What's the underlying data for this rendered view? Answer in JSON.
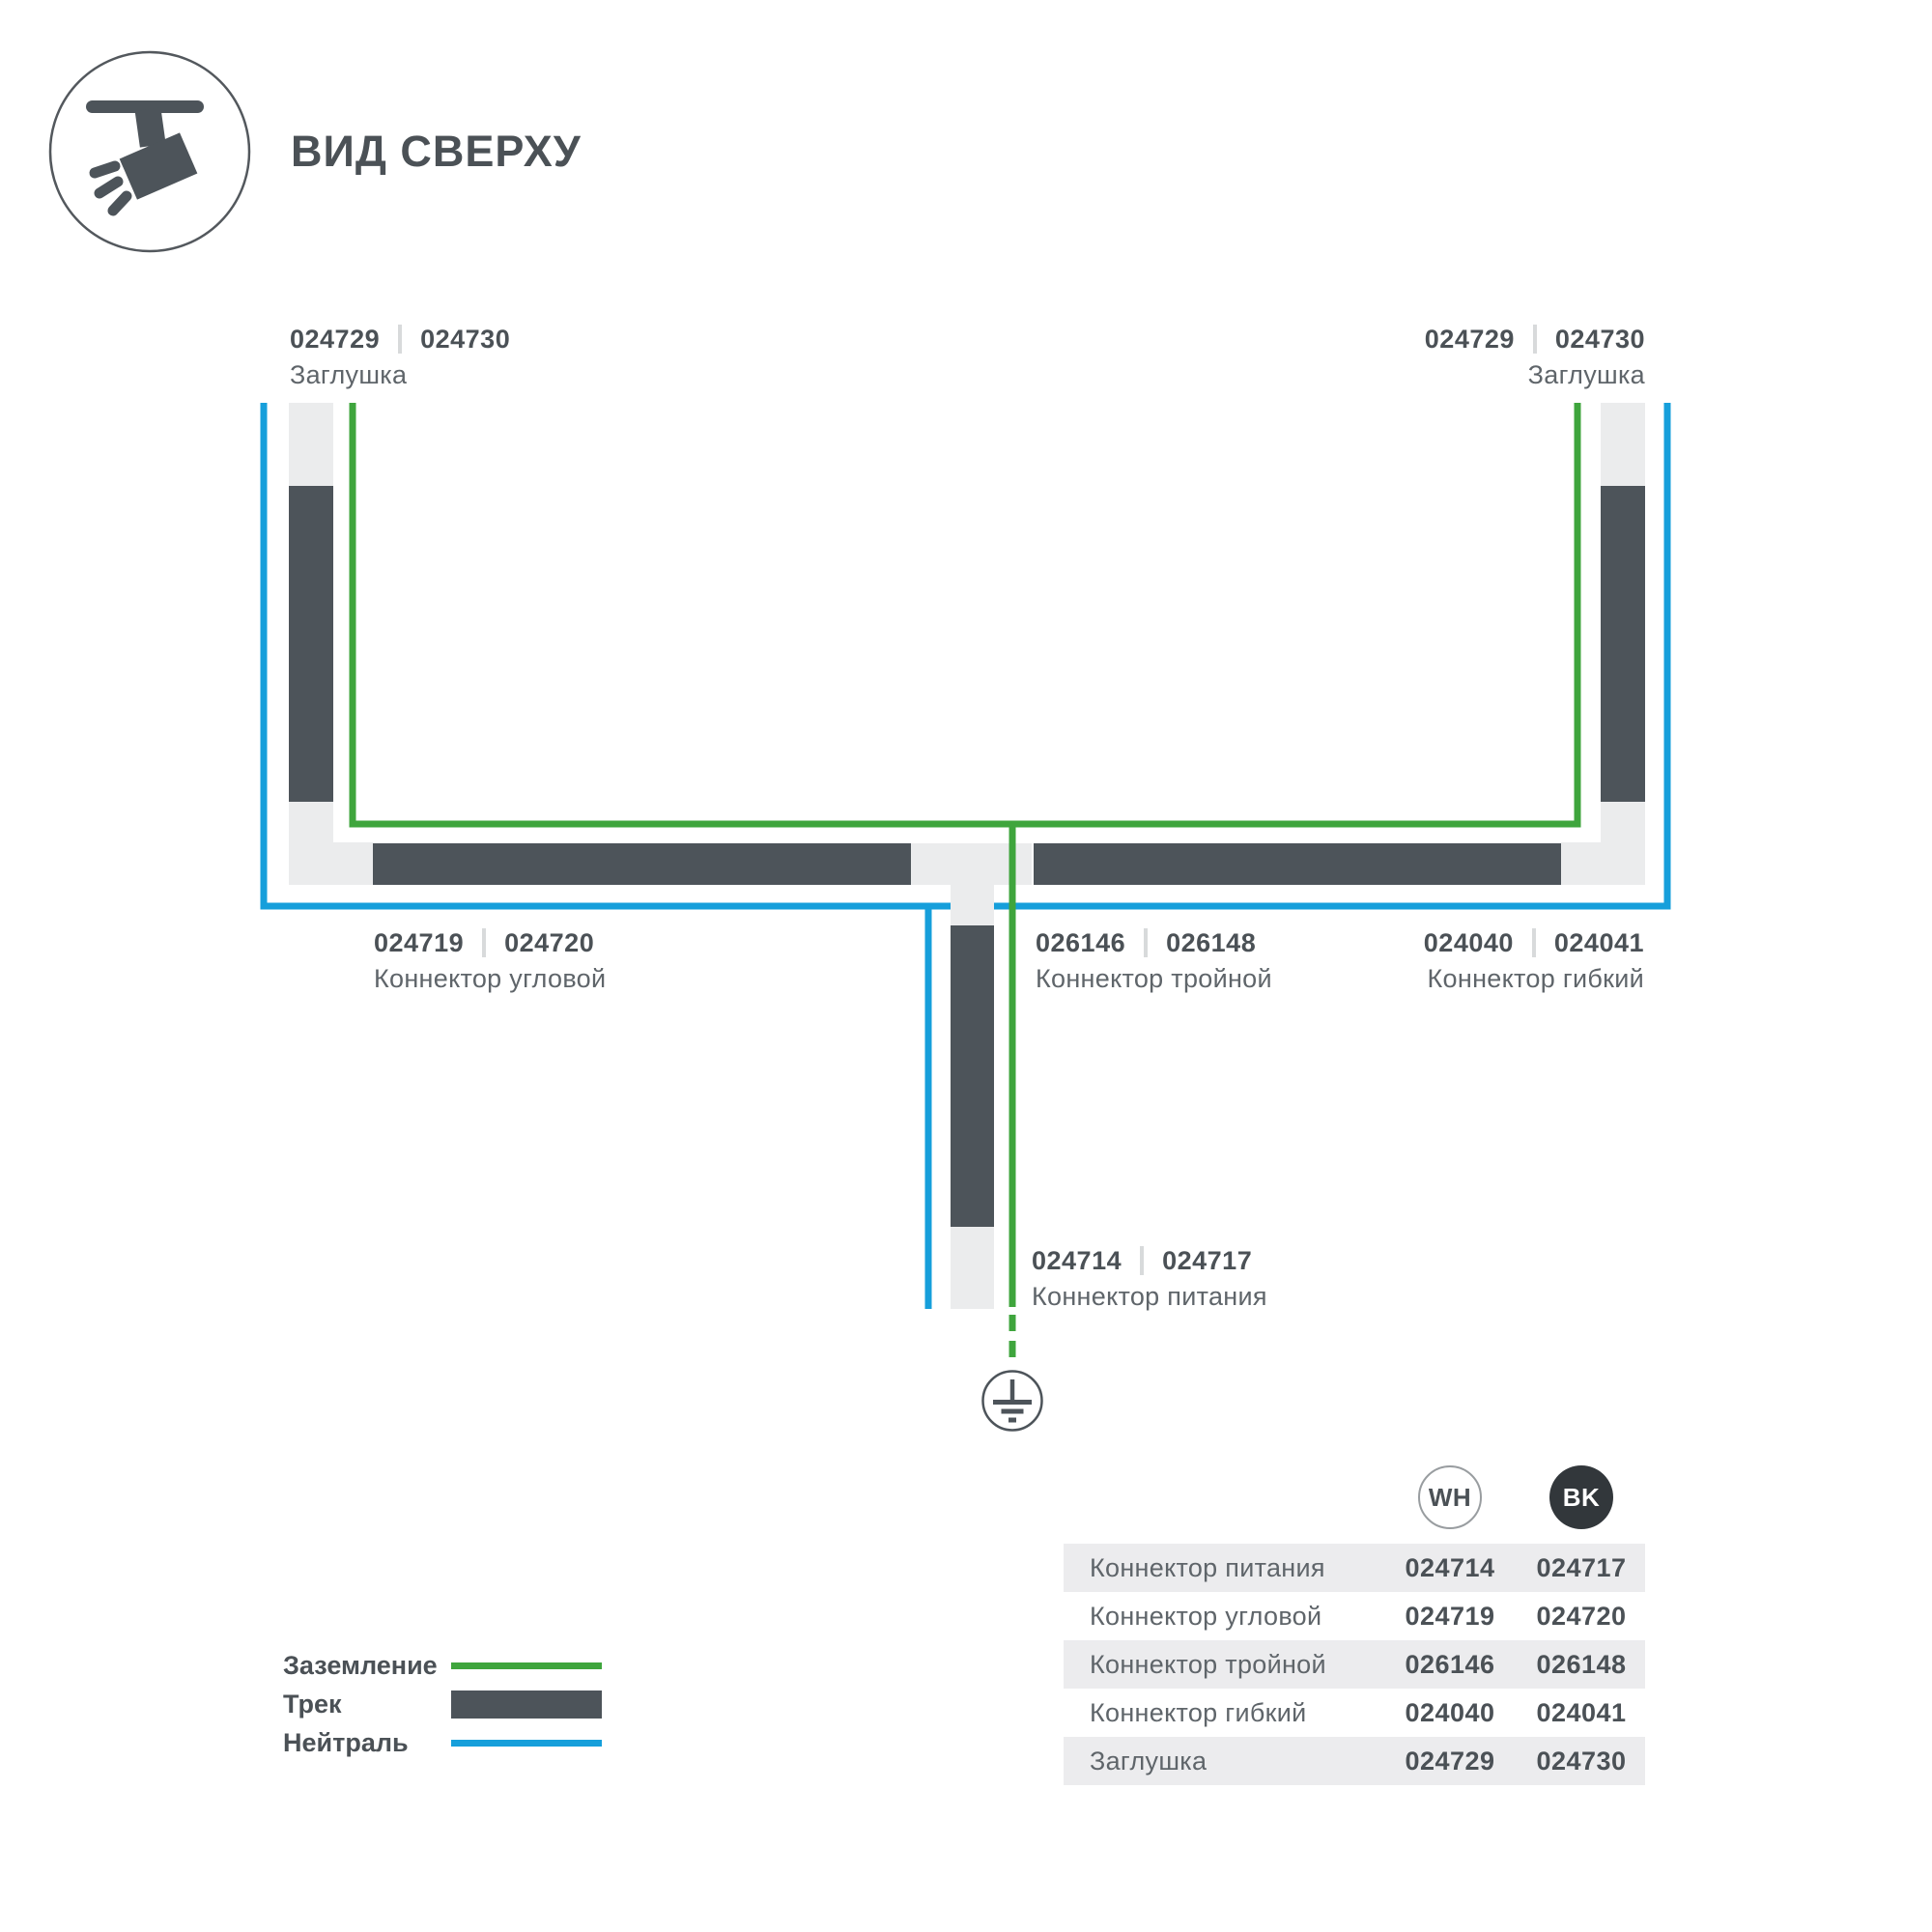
{
  "colors": {
    "track_dark": "#4d545a",
    "track_light": "#ebeced",
    "ground_green": "#3fa53d",
    "neutral_blue": "#169fdb",
    "text_dark": "#4b5156",
    "text_medium": "#5f656a",
    "separator": "#d8dadb",
    "table_stripe": "#ececee",
    "bk_fill": "#32373b",
    "wh_outline": "#999da0"
  },
  "header": {
    "title": "ВИД СВЕРХУ"
  },
  "diagram": {
    "labels": {
      "endcap_left": {
        "codes": [
          "024729",
          "024730"
        ],
        "name": "Заглушка"
      },
      "endcap_right": {
        "codes": [
          "024729",
          "024730"
        ],
        "name": "Заглушка"
      },
      "corner": {
        "codes": [
          "024719",
          "024720"
        ],
        "name": "Коннектор угловой"
      },
      "triple": {
        "codes": [
          "026146",
          "026148"
        ],
        "name": "Коннектор тройной"
      },
      "flex": {
        "codes": [
          "024040",
          "024041"
        ],
        "name": "Коннектор гибкий"
      },
      "power": {
        "codes": [
          "024714",
          "024717"
        ],
        "name": "Коннектор питания"
      }
    }
  },
  "legend": {
    "items": [
      {
        "label": "Заземление",
        "swatch": "ground-line"
      },
      {
        "label": "Трек",
        "swatch": "track-bar"
      },
      {
        "label": "Нейтраль",
        "swatch": "neutral-line"
      }
    ]
  },
  "table": {
    "columns": [
      {
        "code": "WH"
      },
      {
        "code": "BK"
      }
    ],
    "rows": [
      {
        "name": "Коннектор питания",
        "wh": "024714",
        "bk": "024717"
      },
      {
        "name": "Коннектор угловой",
        "wh": "024719",
        "bk": "024720"
      },
      {
        "name": "Коннектор тройной",
        "wh": "026146",
        "bk": "026148"
      },
      {
        "name": "Коннектор гибкий",
        "wh": "024040",
        "bk": "024041"
      },
      {
        "name": "Заглушка",
        "wh": "024729",
        "bk": "024730"
      }
    ]
  }
}
